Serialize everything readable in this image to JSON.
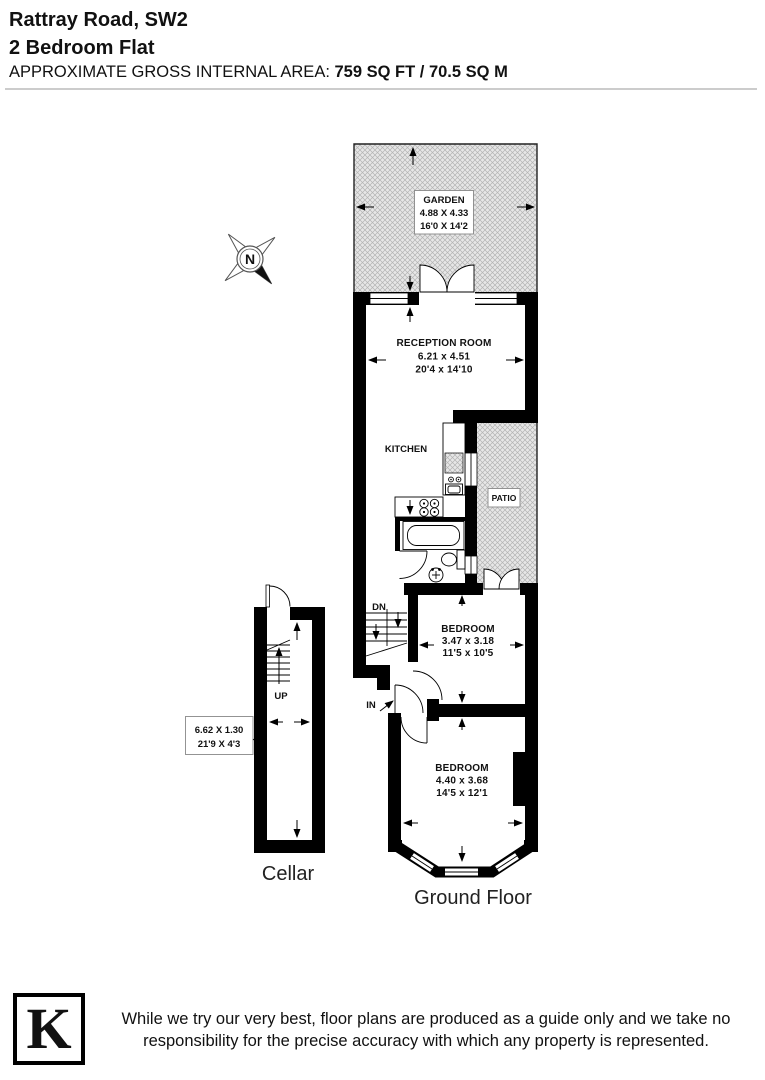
{
  "header": {
    "address": "Rattray Road, SW2",
    "property_type": "2 Bedroom Flat",
    "area_label": "APPROXIMATE GROSS INTERNAL AREA: ",
    "area_value": "759 SQ FT / 70.5 SQ M"
  },
  "plan": {
    "garden": {
      "name": "GARDEN",
      "metric": "4.88 X 4.33",
      "imperial": "16'0 X 14'2"
    },
    "reception": {
      "name": "RECEPTION ROOM",
      "metric": "6.21 x 4.51",
      "imperial": "20'4 x 14'10"
    },
    "kitchen": {
      "name": "KITCHEN"
    },
    "patio": {
      "name": "PATIO"
    },
    "bedroom1": {
      "name": "BEDROOM",
      "metric": "3.47 x 3.18",
      "imperial": "11'5 x 10'5"
    },
    "bedroom2": {
      "name": "BEDROOM",
      "metric": "4.40 x 3.68",
      "imperial": "14'5 x 12'1"
    },
    "cellar": {
      "name": "Cellar",
      "metric": "6.62 X 1.30",
      "imperial": "21'9 X 4'3"
    },
    "stairs": {
      "up": "UP",
      "down": "DN"
    },
    "entrance_label": "IN",
    "compass_north": "N",
    "floor_label": "Ground Floor"
  },
  "footer": {
    "logo_letter": "K",
    "disclaimer_line1": "While we try our very best, floor plans are produced as a guide only and we take no",
    "disclaimer_line2": "responsibility for the precise accuracy with which any property is represented."
  },
  "colors": {
    "wall": "#000000",
    "hatch_bg": "#e7e7e7",
    "hatch_line": "#b3b3b3",
    "rule": "#cccccc"
  }
}
